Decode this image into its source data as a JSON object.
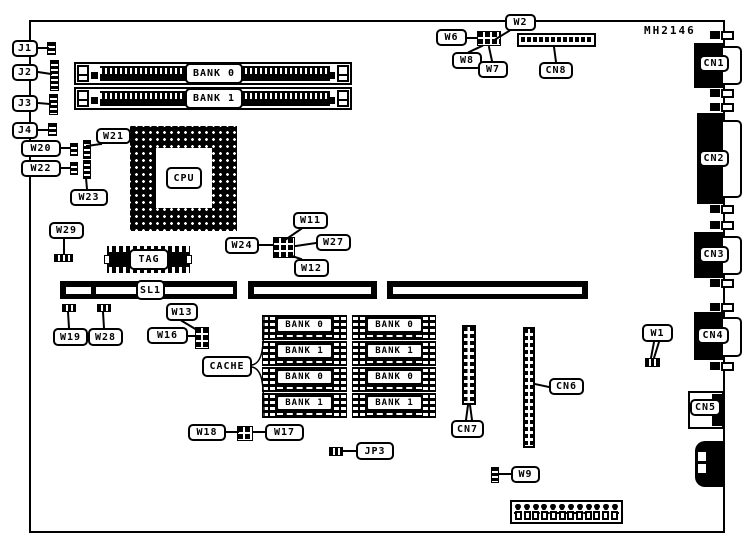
{
  "diagram": {
    "model": "MH2146",
    "cpu_label": "CPU",
    "tag_label": "TAG",
    "slot_label": "SL1",
    "cache_label": "CACHE",
    "simm_banks": [
      "BANK 0",
      "BANK 1"
    ],
    "cache_chips": [
      "BANK 0",
      "BANK 1",
      "BANK 0",
      "BANK 1",
      "BANK 0",
      "BANK 1",
      "BANK 0",
      "BANK 1"
    ],
    "jumpers": {
      "J1": "J1",
      "J2": "J2",
      "J3": "J3",
      "J4": "J4",
      "W1": "W1",
      "W2": "W2",
      "W6": "W6",
      "W7": "W7",
      "W8": "W8",
      "W9": "W9",
      "W11": "W11",
      "W12": "W12",
      "W13": "W13",
      "W16": "W16",
      "W17": "W17",
      "W18": "W18",
      "W19": "W19",
      "W20": "W20",
      "W21": "W21",
      "W22": "W22",
      "W23": "W23",
      "W24": "W24",
      "W27": "W27",
      "W28": "W28",
      "W29": "W29",
      "JP3": "JP3"
    },
    "connectors": {
      "CN1": "CN1",
      "CN2": "CN2",
      "CN3": "CN3",
      "CN4": "CN4",
      "CN5": "CN5",
      "CN6": "CN6",
      "CN7": "CN7",
      "CN8": "CN8"
    }
  }
}
